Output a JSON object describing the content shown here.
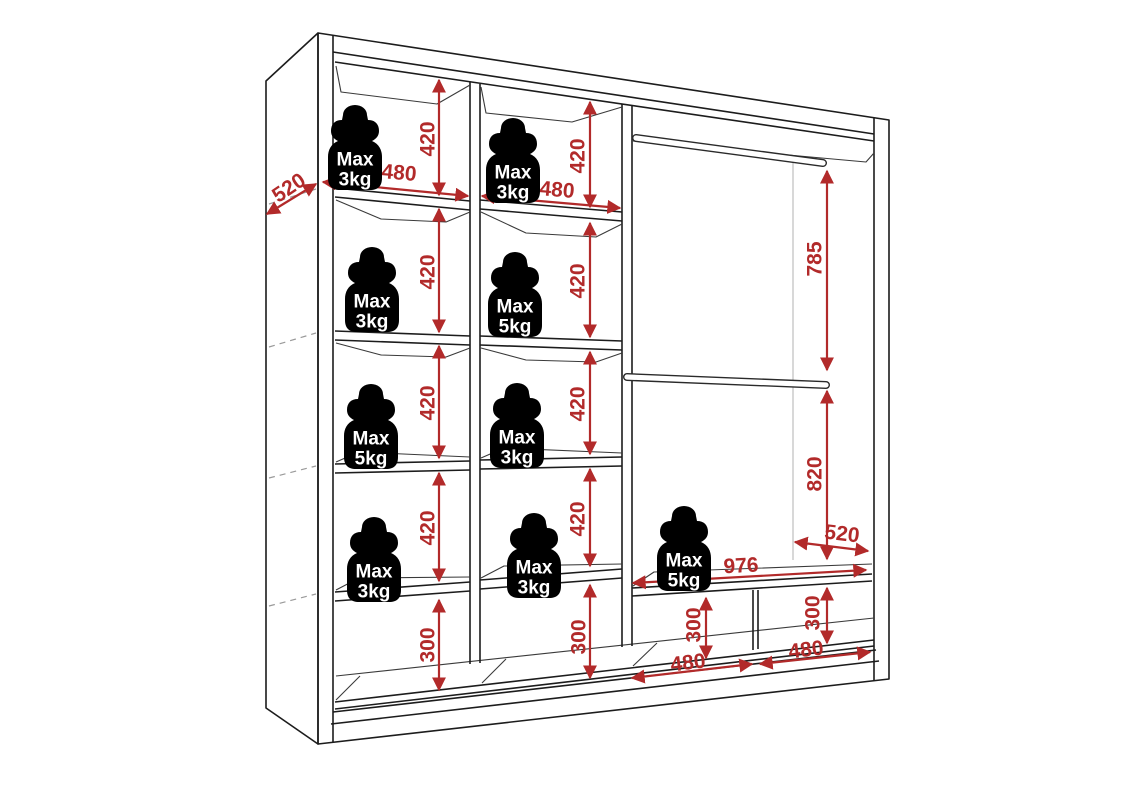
{
  "diagram_type": "wardrobe-interior-dimension-diagram",
  "colors": {
    "dimension_red": "#b22a2a",
    "line_dark": "#1c1c1c",
    "detail_gray": "#3a3a3a",
    "reference_gray": "#b8b8b8",
    "weight_fill": "#000000",
    "weight_text": "#ffffff",
    "background": "#ffffff"
  },
  "weights": [
    {
      "id": "col1-row1",
      "lines": [
        "Max",
        "3kg"
      ]
    },
    {
      "id": "col1-row2",
      "lines": [
        "Max",
        "3kg"
      ]
    },
    {
      "id": "col1-row3",
      "lines": [
        "Max",
        "5kg"
      ]
    },
    {
      "id": "col1-row4",
      "lines": [
        "Max",
        "3kg"
      ]
    },
    {
      "id": "col2-row1",
      "lines": [
        "Max",
        "3kg"
      ]
    },
    {
      "id": "col2-row2",
      "lines": [
        "Max",
        "5kg"
      ]
    },
    {
      "id": "col2-row3",
      "lines": [
        "Max",
        "3kg"
      ]
    },
    {
      "id": "col2-row4",
      "lines": [
        "Max",
        "3kg"
      ]
    },
    {
      "id": "right-shelf",
      "lines": [
        "Max",
        "5kg"
      ]
    }
  ],
  "dimensions": [
    {
      "id": "depth-left",
      "value": "520"
    },
    {
      "id": "col1-width",
      "value": "480"
    },
    {
      "id": "col2-width",
      "value": "480"
    },
    {
      "id": "col1-shelf1-height",
      "value": "420"
    },
    {
      "id": "col1-shelf2-height",
      "value": "420"
    },
    {
      "id": "col1-shelf3-height",
      "value": "420"
    },
    {
      "id": "col1-shelf4-height",
      "value": "420"
    },
    {
      "id": "col1-bottom-height",
      "value": "300"
    },
    {
      "id": "col2-shelf1-height",
      "value": "420"
    },
    {
      "id": "col2-shelf2-height",
      "value": "420"
    },
    {
      "id": "col2-shelf3-height",
      "value": "420"
    },
    {
      "id": "col2-shelf4-height",
      "value": "420"
    },
    {
      "id": "col2-bottom-height",
      "value": "300"
    },
    {
      "id": "rail-upper-height",
      "value": "785"
    },
    {
      "id": "rail-lower-height",
      "value": "820"
    },
    {
      "id": "depth-right",
      "value": "520"
    },
    {
      "id": "right-shelf-width",
      "value": "976"
    },
    {
      "id": "bottomright-left-height",
      "value": "300"
    },
    {
      "id": "bottomright-right-height",
      "value": "300"
    },
    {
      "id": "bottomright-left-width",
      "value": "480"
    },
    {
      "id": "bottomright-right-width",
      "value": "480"
    }
  ]
}
